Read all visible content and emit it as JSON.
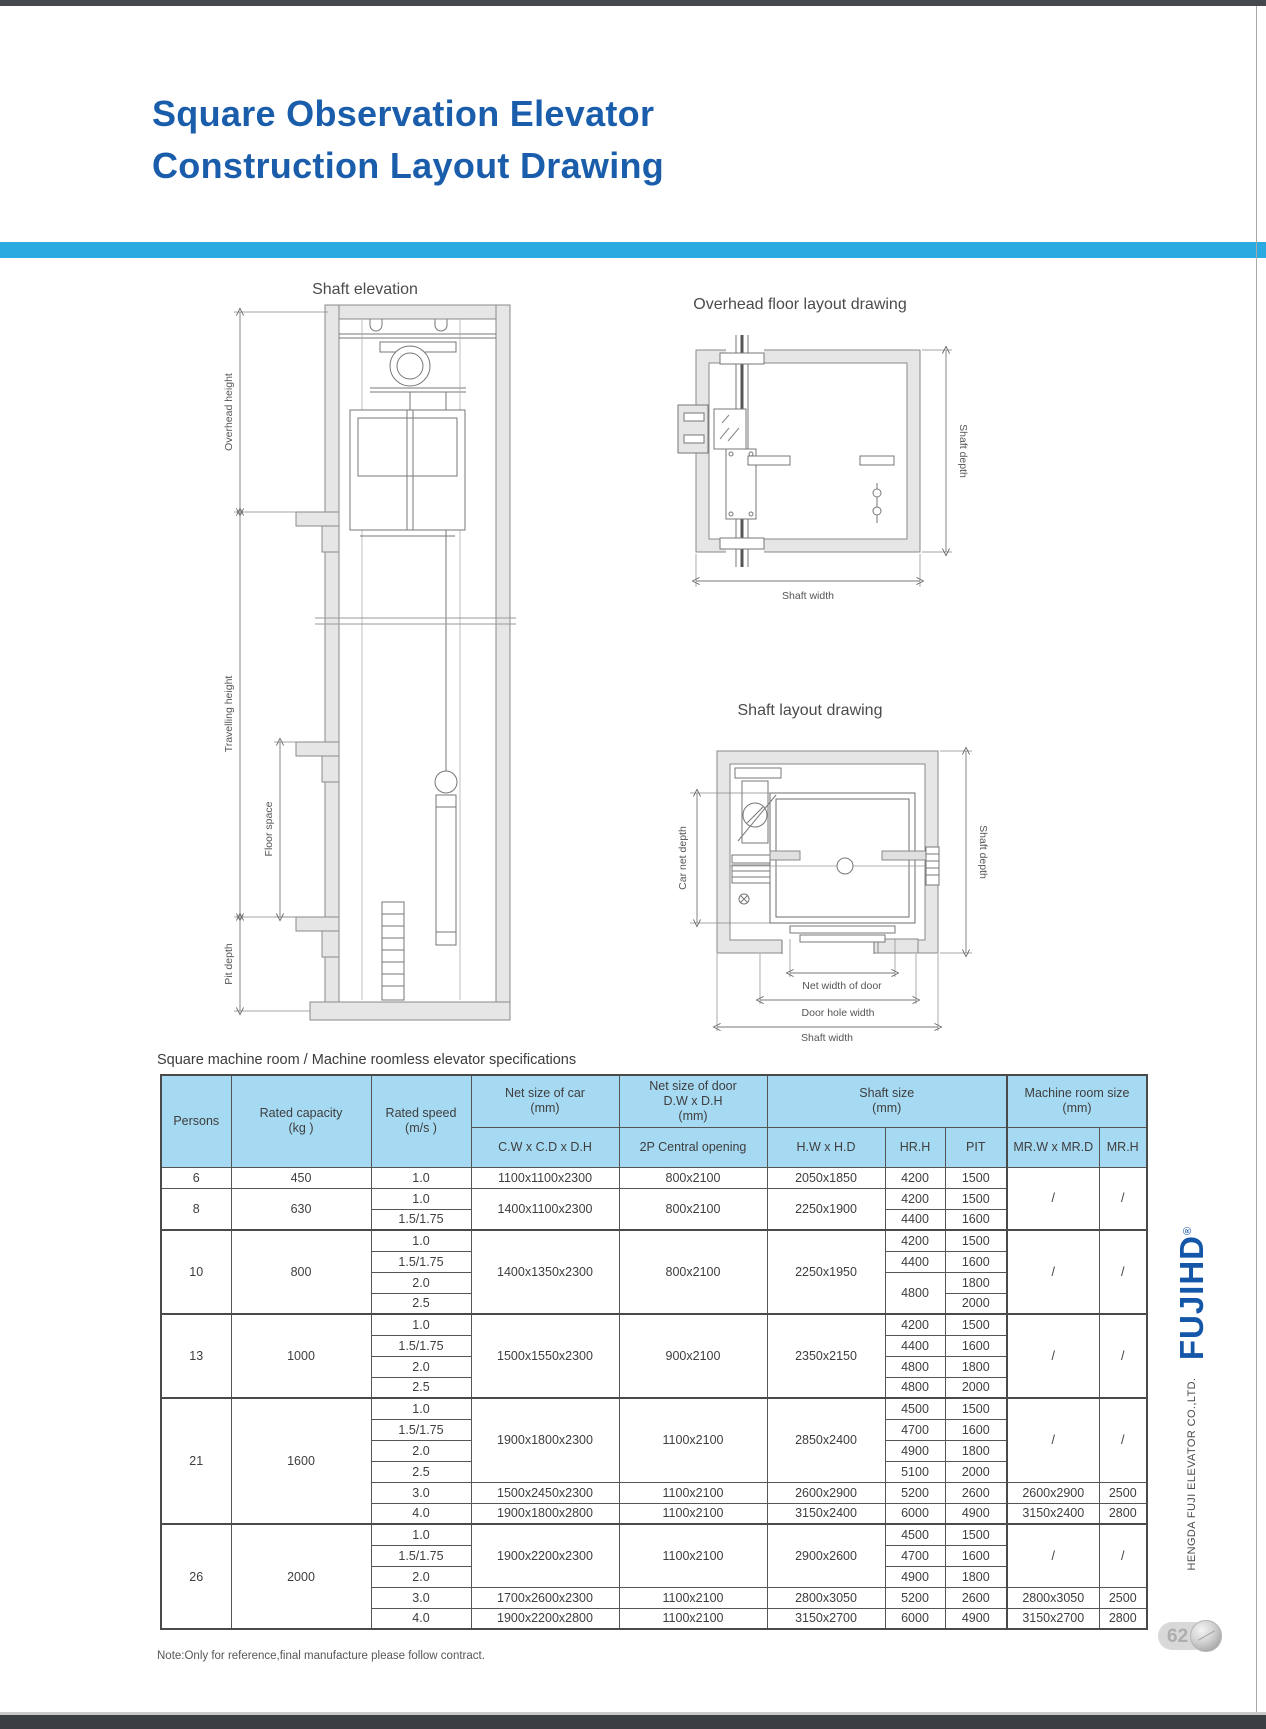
{
  "page": {
    "title_line1": "Square Observation Elevator",
    "title_line2": "Construction Layout Drawing",
    "note": "Note:Only for reference,final manufacture please follow contract.",
    "page_number": "62"
  },
  "brand": {
    "logo": "FUJIHD",
    "registered": "®",
    "company": "HENGDA FUJI ELEVATOR CO.,LTD."
  },
  "colors": {
    "title_blue": "#1a5dab",
    "accent_cyan": "#29abe2",
    "table_header_bg": "#a6d9f2"
  },
  "drawings": {
    "shaft_elevation": {
      "title": "Shaft elevation",
      "overhead_height": "Overhead height",
      "travelling_height": "Travelling height",
      "floor_space": "Floor space",
      "pit_depth": "Pit depth"
    },
    "overhead_layout": {
      "title": "Overhead floor layout drawing",
      "shaft_depth": "Shaft depth",
      "shaft_width": "Shaft width"
    },
    "shaft_layout": {
      "title": "Shaft layout drawing",
      "car_net_depth": "Car net depth",
      "shaft_depth": "Shaft depth",
      "net_width_of_door": "Net width of door",
      "door_hole_width": "Door hole width",
      "shaft_width": "Shaft width"
    }
  },
  "table": {
    "caption": "Square machine room / Machine roomless elevator specifications",
    "col_widths": [
      70,
      140,
      100,
      148,
      148,
      118,
      60,
      62,
      92,
      48
    ],
    "header_rows": [
      [
        {
          "t": "Persons",
          "rs": 2
        },
        {
          "t": "Rated capacity\n(kg )",
          "rs": 2
        },
        {
          "t": "Rated speed\n(m/s )",
          "rs": 2
        },
        {
          "t": "Net size of car\n(mm)"
        },
        {
          "t": "Net size of door\nD.W x D.H\n(mm)"
        },
        {
          "t": "Shaft size\n(mm)",
          "cs": 3
        },
        {
          "t": "Machine room size\n(mm)",
          "cs": 2,
          "cls": "bl2"
        }
      ],
      [
        {
          "t": "C.W x C.D x D.H"
        },
        {
          "t": "2P Central opening"
        },
        {
          "t": "H.W x H.D"
        },
        {
          "t": "HR.H"
        },
        {
          "t": "PIT"
        },
        {
          "t": "MR.W x MR.D",
          "cls": "bl2"
        },
        {
          "t": "MR.H"
        }
      ]
    ],
    "body_rows": [
      {
        "cells": [
          {
            "t": "6"
          },
          {
            "t": "450"
          },
          {
            "t": "1.0"
          },
          {
            "t": "1100x1100x2300"
          },
          {
            "t": "800x2100"
          },
          {
            "t": "2050x1850"
          },
          {
            "t": "4200"
          },
          {
            "t": "1500"
          },
          {
            "t": "/",
            "rs": 3,
            "cls": "bl2"
          },
          {
            "t": "/",
            "rs": 3
          }
        ]
      },
      {
        "cells": [
          {
            "t": "8",
            "rs": 2
          },
          {
            "t": "630",
            "rs": 2
          },
          {
            "t": "1.0"
          },
          {
            "t": "1400x1100x2300",
            "rs": 2
          },
          {
            "t": "800x2100",
            "rs": 2
          },
          {
            "t": "2250x1900",
            "rs": 2
          },
          {
            "t": "4200"
          },
          {
            "t": "1500"
          }
        ]
      },
      {
        "cells": [
          {
            "t": "1.5/1.75"
          },
          {
            "t": "4400"
          },
          {
            "t": "1600"
          }
        ]
      },
      {
        "g": 1,
        "cells": [
          {
            "t": "10",
            "rs": 4
          },
          {
            "t": "800",
            "rs": 4
          },
          {
            "t": "1.0"
          },
          {
            "t": "1400x1350x2300",
            "rs": 4
          },
          {
            "t": "800x2100",
            "rs": 4
          },
          {
            "t": "2250x1950",
            "rs": 4
          },
          {
            "t": "4200"
          },
          {
            "t": "1500"
          },
          {
            "t": "/",
            "rs": 4,
            "cls": "bl2"
          },
          {
            "t": "/",
            "rs": 4
          }
        ]
      },
      {
        "cells": [
          {
            "t": "1.5/1.75"
          },
          {
            "t": "4400"
          },
          {
            "t": "1600"
          }
        ]
      },
      {
        "cells": [
          {
            "t": "2.0"
          },
          {
            "t": "4800",
            "rs": 2
          },
          {
            "t": "1800"
          }
        ]
      },
      {
        "cells": [
          {
            "t": "2.5"
          },
          {
            "t": "2000"
          }
        ]
      },
      {
        "g": 1,
        "cells": [
          {
            "t": "13",
            "rs": 4
          },
          {
            "t": "1000",
            "rs": 4
          },
          {
            "t": "1.0"
          },
          {
            "t": "1500x1550x2300",
            "rs": 4
          },
          {
            "t": "900x2100",
            "rs": 4
          },
          {
            "t": "2350x2150",
            "rs": 4
          },
          {
            "t": "4200"
          },
          {
            "t": "1500"
          },
          {
            "t": "/",
            "rs": 4,
            "cls": "bl2"
          },
          {
            "t": "/",
            "rs": 4
          }
        ]
      },
      {
        "cells": [
          {
            "t": "1.5/1.75"
          },
          {
            "t": "4400"
          },
          {
            "t": "1600"
          }
        ]
      },
      {
        "cells": [
          {
            "t": "2.0"
          },
          {
            "t": "4800"
          },
          {
            "t": "1800"
          }
        ]
      },
      {
        "cells": [
          {
            "t": "2.5"
          },
          {
            "t": "4800"
          },
          {
            "t": "2000"
          }
        ]
      },
      {
        "g": 1,
        "cells": [
          {
            "t": "21",
            "rs": 6
          },
          {
            "t": "1600",
            "rs": 6
          },
          {
            "t": "1.0"
          },
          {
            "t": "1900x1800x2300",
            "rs": 4
          },
          {
            "t": "1100x2100",
            "rs": 4
          },
          {
            "t": "2850x2400",
            "rs": 4
          },
          {
            "t": "4500"
          },
          {
            "t": "1500"
          },
          {
            "t": "/",
            "rs": 4,
            "cls": "bl2"
          },
          {
            "t": "/",
            "rs": 4
          }
        ]
      },
      {
        "cells": [
          {
            "t": "1.5/1.75"
          },
          {
            "t": "4700"
          },
          {
            "t": "1600"
          }
        ]
      },
      {
        "cells": [
          {
            "t": "2.0"
          },
          {
            "t": "4900"
          },
          {
            "t": "1800"
          }
        ]
      },
      {
        "cells": [
          {
            "t": "2.5"
          },
          {
            "t": "5100"
          },
          {
            "t": "2000"
          }
        ]
      },
      {
        "cells": [
          {
            "t": "3.0"
          },
          {
            "t": "1500x2450x2300"
          },
          {
            "t": "1100x2100"
          },
          {
            "t": "2600x2900"
          },
          {
            "t": "5200"
          },
          {
            "t": "2600"
          },
          {
            "t": "2600x2900",
            "cls": "bl2"
          },
          {
            "t": "2500"
          }
        ]
      },
      {
        "cells": [
          {
            "t": "4.0"
          },
          {
            "t": "1900x1800x2800"
          },
          {
            "t": "1100x2100"
          },
          {
            "t": "3150x2400"
          },
          {
            "t": "6000"
          },
          {
            "t": "4900"
          },
          {
            "t": "3150x2400",
            "cls": "bl2"
          },
          {
            "t": "2800"
          }
        ]
      },
      {
        "g": 1,
        "cells": [
          {
            "t": "26",
            "rs": 5
          },
          {
            "t": "2000",
            "rs": 5
          },
          {
            "t": "1.0"
          },
          {
            "t": "1900x2200x2300",
            "rs": 3
          },
          {
            "t": "1100x2100",
            "rs": 3
          },
          {
            "t": "2900x2600",
            "rs": 3
          },
          {
            "t": "4500"
          },
          {
            "t": "1500"
          },
          {
            "t": "/",
            "rs": 3,
            "cls": "bl2"
          },
          {
            "t": "/",
            "rs": 3
          }
        ]
      },
      {
        "cells": [
          {
            "t": "1.5/1.75"
          },
          {
            "t": "4700"
          },
          {
            "t": "1600"
          }
        ]
      },
      {
        "cells": [
          {
            "t": "2.0"
          },
          {
            "t": "4900"
          },
          {
            "t": "1800"
          }
        ]
      },
      {
        "cells": [
          {
            "t": "3.0"
          },
          {
            "t": "1700x2600x2300"
          },
          {
            "t": "1100x2100"
          },
          {
            "t": "2800x3050"
          },
          {
            "t": "5200"
          },
          {
            "t": "2600"
          },
          {
            "t": "2800x3050",
            "cls": "bl2"
          },
          {
            "t": "2500"
          }
        ]
      },
      {
        "cells": [
          {
            "t": "4.0"
          },
          {
            "t": "1900x2200x2800"
          },
          {
            "t": "1100x2100"
          },
          {
            "t": "3150x2700"
          },
          {
            "t": "6000"
          },
          {
            "t": "4900"
          },
          {
            "t": "3150x2700",
            "cls": "bl2"
          },
          {
            "t": "2800"
          }
        ]
      }
    ]
  }
}
